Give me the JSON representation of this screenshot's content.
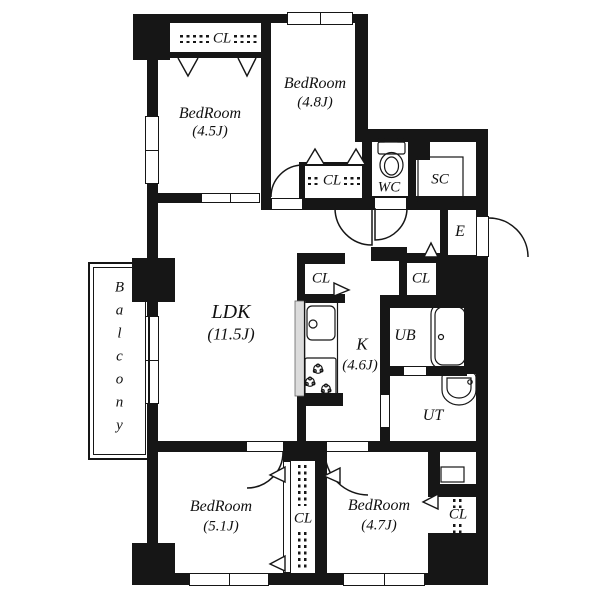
{
  "plan": {
    "rooms": {
      "bedroom_top_left": {
        "name": "BedRoom",
        "size": "(4.5J)"
      },
      "bedroom_top_mid": {
        "name": "BedRoom",
        "size": "(4.8J)"
      },
      "ldk": {
        "name": "LDK",
        "size": "(11.5J)"
      },
      "kitchen": {
        "name": "K",
        "size": "(4.6J)"
      },
      "bedroom_bottom_left": {
        "name": "BedRoom",
        "size": "(5.1J)"
      },
      "bedroom_bottom_right": {
        "name": "BedRoom",
        "size": "(4.7J)"
      },
      "balcony": {
        "name": "Balcony"
      },
      "wc": {
        "name": "WC"
      },
      "shoe_closet": {
        "name": "SC"
      },
      "entrance": {
        "name": "E"
      },
      "unit_bath": {
        "name": "UB"
      },
      "utility": {
        "name": "UT"
      }
    },
    "closets": {
      "top": {
        "label": "CL"
      },
      "bedroom48": {
        "label": "CL"
      },
      "kitchen": {
        "label": "CL"
      },
      "hall": {
        "label": "CL"
      },
      "bottom_center": {
        "label": "CL"
      },
      "bottom_right": {
        "label": "CL"
      }
    },
    "colors": {
      "wall": "#161616",
      "background": "#ffffff"
    }
  }
}
